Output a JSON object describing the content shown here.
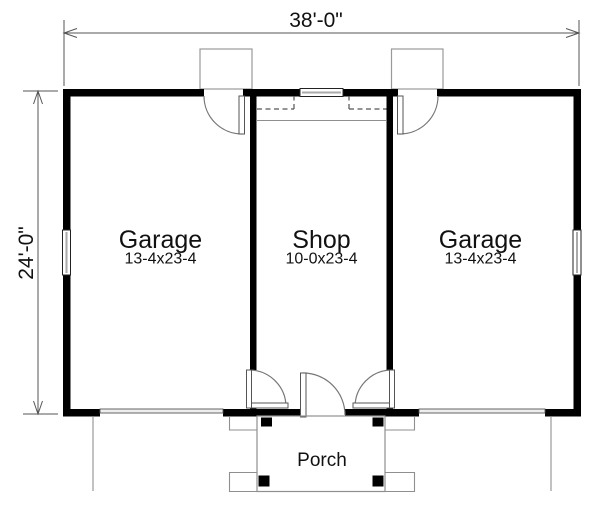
{
  "plan": {
    "width_dim": "38'-0\"",
    "height_dim": "24'-0\"",
    "rooms": [
      {
        "name": "Garage",
        "size": "13-4x23-4"
      },
      {
        "name": "Shop",
        "size": "10-0x23-4"
      },
      {
        "name": "Garage",
        "size": "13-4x23-4"
      }
    ],
    "porch_label": "Porch"
  },
  "colors": {
    "wall": "#000000",
    "background": "#ffffff",
    "dimension_line": "#555555",
    "light_line": "#8f8f8f"
  }
}
